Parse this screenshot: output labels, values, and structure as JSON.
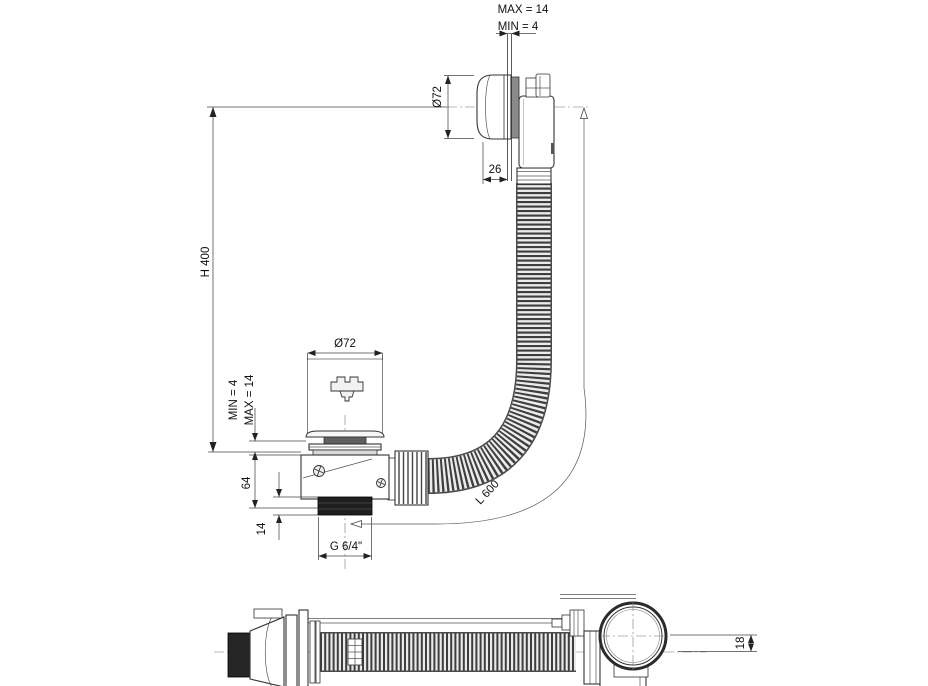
{
  "colors": {
    "background": "#ffffff",
    "line": "#333333",
    "dimension": "#444444",
    "hose_dark": "#3e3e3e",
    "hose_light": "#eaeaea",
    "thread_dark": "#1f1f1f"
  },
  "main_view": {
    "dim_wall_max": "MAX = 14",
    "dim_wall_min": "MIN = 4",
    "dim_overflow_diameter": "Ø72",
    "dim_overflow_projection": "26",
    "dim_install_height": "H 400",
    "dim_drain_diameter": "Ø72",
    "dim_floor_min": "MIN = 4",
    "dim_floor_max": "MAX = 14",
    "dim_body_height": "64",
    "dim_thread_length": "14",
    "dim_thread_size": "G 6/4\"",
    "dim_hose_length": "L 600"
  },
  "plan_view": {
    "dim_cap_offset": "18"
  }
}
